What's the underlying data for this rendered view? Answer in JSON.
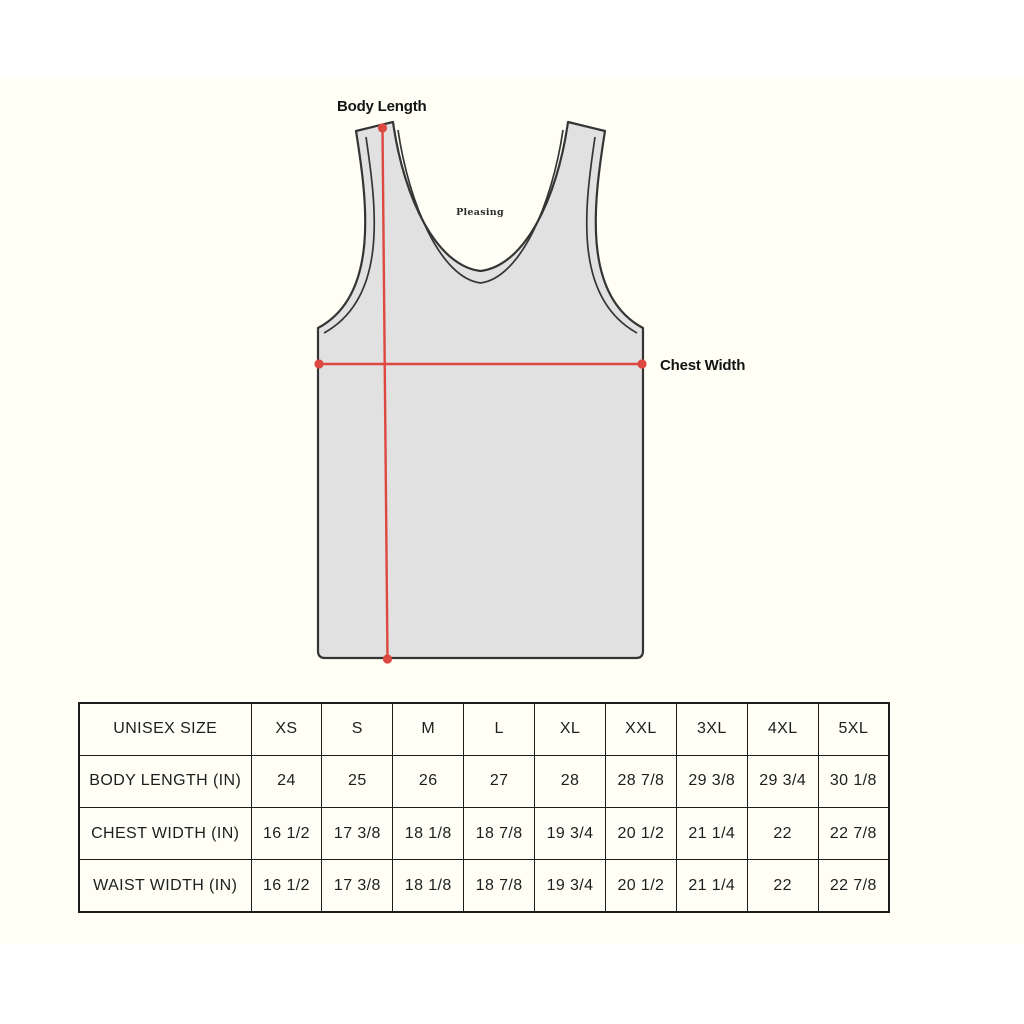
{
  "diagram": {
    "brand_logo": "Pleasing",
    "labels": {
      "body_length": "Body Length",
      "chest_width": "Chest Width"
    },
    "colors": {
      "garment_fill": "#e1e1e1",
      "outline": "#353535",
      "measure_red": "#dd4840",
      "canvas_background": "#fffff6"
    }
  },
  "size_table": {
    "rows": [
      [
        "UNISEX SIZE",
        "XS",
        "S",
        "M",
        "L",
        "XL",
        "XXL",
        "3XL",
        "4XL",
        "5XL"
      ],
      [
        "BODY LENGTH (IN)",
        "24",
        "25",
        "26",
        "27",
        "28",
        "28 7/8",
        "29 3/8",
        "29 3/4",
        "30 1/8"
      ],
      [
        "CHEST WIDTH (IN)",
        "16 1/2",
        "17 3/8",
        "18 1/8",
        "18 7/8",
        "19 3/4",
        "20 1/2",
        "21 1/4",
        "22",
        "22 7/8"
      ],
      [
        "WAIST WIDTH (IN)",
        "16 1/2",
        "17 3/8",
        "18 1/8",
        "18 7/8",
        "19 3/4",
        "20 1/2",
        "21 1/4",
        "22",
        "22 7/8"
      ]
    ]
  }
}
